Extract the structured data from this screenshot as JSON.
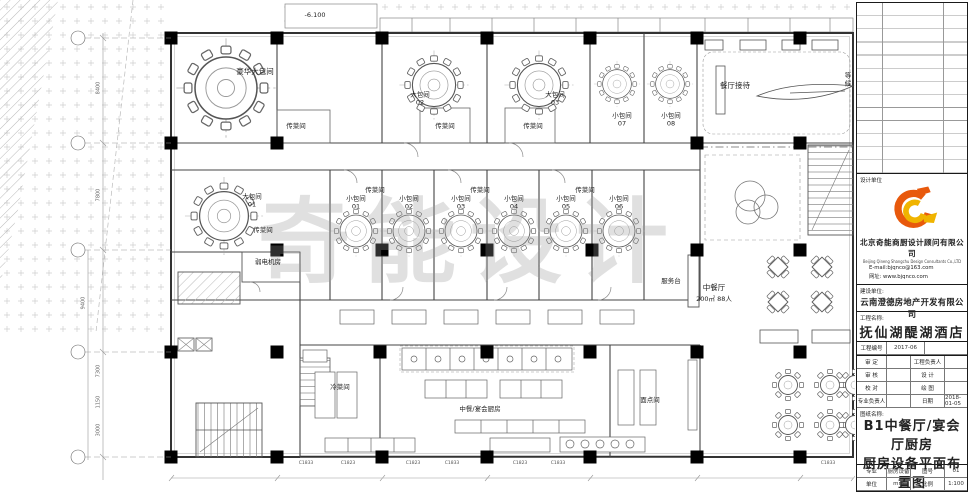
{
  "plan": {
    "watermark": "奇能设计",
    "elevation": "-6.100",
    "rooms": {
      "luxury": "豪华大包间",
      "large01": "大包间\n01",
      "large02": "大包间\n02",
      "large03": "大包间\n03",
      "small01": "小包间\n01",
      "small02": "小包间\n02",
      "small03": "小包间\n03",
      "small04": "小包间\n04",
      "small05": "小包间\n05",
      "small06": "小包间\n06",
      "small07": "小包间\n07",
      "small08": "小包间\n08",
      "pass": "传菜间",
      "reception": "餐厅接待",
      "waiting": "等候",
      "weak_power": "弱电机房",
      "service_desk": "服务台",
      "restaurant": "中餐厅",
      "restaurant_capacity": "200㎡ 88人",
      "cold_dish": "冷菜间",
      "main_kitchen": "中餐/宴会厨房",
      "pastry": "面点间"
    },
    "window_tags": [
      "C1833",
      "C1823",
      "C1823",
      "C1833",
      "C1823",
      "C1833",
      "C1833"
    ],
    "dims": [
      "8400",
      "7800",
      "9400",
      "7300",
      "1150",
      "3000"
    ]
  },
  "title_block": {
    "design_unit_label": "设计单位",
    "design_company_cn": "北京奇能商厨设计顾问有限公司",
    "design_company_en": "Beijing Qineng Shangchu Design Consultants Co.,LTD",
    "email": "E-mail:bjqnco@163.com",
    "website": "网址: www.bjqnco.com",
    "client_label": "建设单位:",
    "client_name": "云南澄德房地产开发有限公司",
    "project_label": "工程名称:",
    "project_name": "抚仙湖醍湖酒店",
    "project_no_label": "工程编号",
    "project_no": "2017-06",
    "sign_rows": [
      {
        "l1": "审 定",
        "v1": "",
        "l2": "工程负责人",
        "v2": ""
      },
      {
        "l1": "审 核",
        "v1": "",
        "l2": "设 计",
        "v2": ""
      },
      {
        "l1": "校 对",
        "v1": "",
        "l2": "绘 图",
        "v2": ""
      },
      {
        "l1": "专业负责人",
        "v1": "",
        "l2": "日期",
        "v2": "2018-01-05"
      }
    ],
    "drawing_name_label": "图纸名称:",
    "drawing_name_line1": "B1中餐厅/宴会厅厨房",
    "drawing_name_line2": "厨房设备平面布置图",
    "bottom_rows": [
      {
        "l1": "专业",
        "v1": "厨房设备",
        "l2": "图号",
        "v2": "01"
      },
      {
        "l1": "单位",
        "v1": "mm",
        "l2": "比例",
        "v2": "1:100"
      }
    ]
  }
}
